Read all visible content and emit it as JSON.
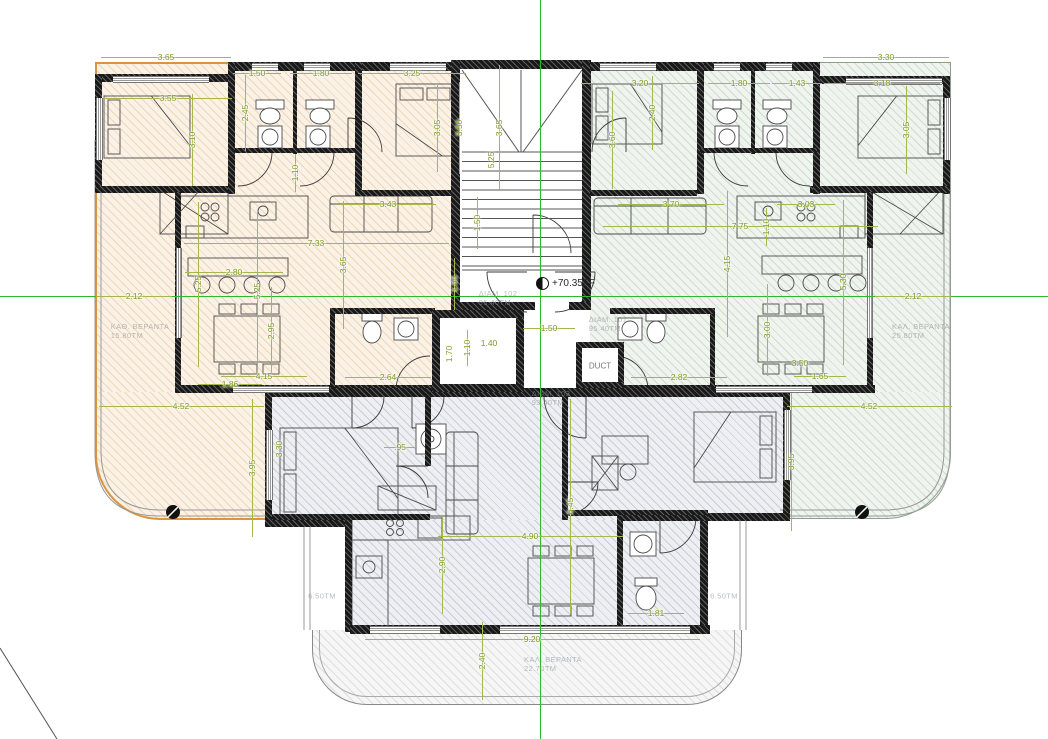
{
  "drawing": {
    "title": "apartment-floor-plan",
    "annotations": {
      "level_marker": "+70.35FF",
      "duct_label": "DUCT"
    },
    "area_labels": [
      {
        "lines": [
          "ΚΑΘ. ΒΕΡΑΝΤΑ",
          "15.80ΤΜ"
        ],
        "x": 140,
        "y": 331
      },
      {
        "lines": [
          "ΚΑΛ. ΒΕΡΑΝΤΑ",
          "25.80ΤΜ"
        ],
        "x": 921,
        "y": 331
      },
      {
        "lines": [
          "ΚΑΛ. ΒΕΡΑΝΤΑ",
          "22.70ΤΜ"
        ],
        "x": 553,
        "y": 664
      },
      {
        "lines": [
          "6.50ΤΜ"
        ],
        "x": 322,
        "y": 596
      },
      {
        "lines": [
          "6.50ΤΜ"
        ],
        "x": 724,
        "y": 596
      },
      {
        "lines": [
          "ΔΙΑΜ. 102",
          "95.40ΤΜ"
        ],
        "x": 498,
        "y": 298
      },
      {
        "lines": [
          "ΔΙΑΜ. 101",
          "95.40ΤΜ"
        ],
        "x": 608,
        "y": 324
      },
      {
        "lines": [
          "ΔΙΑΜ. 103",
          "93.40ΤΜ"
        ],
        "x": 551,
        "y": 398
      }
    ],
    "dimensions": [
      {
        "t": "3.65",
        "x": 166,
        "y": 57,
        "v": false,
        "len": 130
      },
      {
        "t": "1.50",
        "x": 257,
        "y": 73,
        "v": false,
        "len": 48
      },
      {
        "t": "1.80",
        "x": 321,
        "y": 73,
        "v": false,
        "len": 62
      },
      {
        "t": "3.25",
        "x": 412,
        "y": 73,
        "v": false,
        "len": 108
      },
      {
        "t": "3.55",
        "x": 168,
        "y": 98,
        "v": false,
        "len": 128
      },
      {
        "t": "3.10",
        "x": 192,
        "y": 140,
        "v": true,
        "len": 92
      },
      {
        "t": "2.45",
        "x": 245,
        "y": 113,
        "v": true,
        "len": 76
      },
      {
        "t": "3.05",
        "x": 437,
        "y": 128,
        "v": true,
        "len": 88
      },
      {
        "t": "3.50",
        "x": 459,
        "y": 128,
        "v": true,
        "len": 92
      },
      {
        "t": "1.10",
        "x": 295,
        "y": 173,
        "v": true,
        "len": 38
      },
      {
        "t": "3.43",
        "x": 388,
        "y": 204,
        "v": false,
        "len": 96
      },
      {
        "t": "7.33",
        "x": 316,
        "y": 243,
        "v": false,
        "len": 265
      },
      {
        "t": "2.80",
        "x": 234,
        "y": 272,
        "v": false,
        "len": 98
      },
      {
        "t": "5.25",
        "x": 198,
        "y": 284,
        "v": true,
        "len": 165
      },
      {
        "t": "5.25",
        "x": 257,
        "y": 291,
        "v": true,
        "len": 158
      },
      {
        "t": "2.95",
        "x": 271,
        "y": 331,
        "v": true,
        "len": 88
      },
      {
        "t": "3.65",
        "x": 343,
        "y": 265,
        "v": true,
        "len": 128
      },
      {
        "t": "2.12",
        "x": 134,
        "y": 296,
        "v": false,
        "len": 76
      },
      {
        "t": "1.86",
        "x": 230,
        "y": 384,
        "v": false,
        "len": 64
      },
      {
        "t": "4.15",
        "x": 264,
        "y": 376,
        "v": false,
        "len": 86
      },
      {
        "t": "4.52",
        "x": 181,
        "y": 406,
        "v": false,
        "len": 165
      },
      {
        "t": "2.64",
        "x": 388,
        "y": 377,
        "v": false,
        "len": 86
      },
      {
        "t": "3.95",
        "x": 252,
        "y": 468,
        "v": true,
        "len": 138
      },
      {
        "t": "3.30",
        "x": 279,
        "y": 449,
        "v": true,
        "len": 0
      },
      {
        "t": "3.65",
        "x": 499,
        "y": 128,
        "v": true,
        "len": 126
      },
      {
        "t": "5.25",
        "x": 491,
        "y": 160,
        "v": true,
        "len": 0
      },
      {
        "t": "1.50",
        "x": 477,
        "y": 223,
        "v": true,
        "len": 52
      },
      {
        "t": "1.55",
        "x": 454,
        "y": 284,
        "v": true,
        "len": 52
      },
      {
        "t": "1.70",
        "x": 449,
        "y": 354,
        "v": true,
        "len": 0
      },
      {
        "t": "1.10",
        "x": 467,
        "y": 348,
        "v": true,
        "len": 36
      },
      {
        "t": "1.40",
        "x": 489,
        "y": 343,
        "v": false,
        "len": 0
      },
      {
        "t": "1.50",
        "x": 549,
        "y": 328,
        "v": false,
        "len": 52
      },
      {
        "t": "3.30",
        "x": 886,
        "y": 57,
        "v": false,
        "len": 126
      },
      {
        "t": "3.20",
        "x": 640,
        "y": 83,
        "v": false,
        "len": 118
      },
      {
        "t": "1.80",
        "x": 739,
        "y": 83,
        "v": false,
        "len": 62
      },
      {
        "t": "1.43",
        "x": 797,
        "y": 83,
        "v": false,
        "len": 50
      },
      {
        "t": "3.18",
        "x": 882,
        "y": 83,
        "v": false,
        "len": 116
      },
      {
        "t": "3.60",
        "x": 612,
        "y": 140,
        "v": true,
        "len": 98
      },
      {
        "t": "2.40",
        "x": 652,
        "y": 113,
        "v": true,
        "len": 74
      },
      {
        "t": "3.05",
        "x": 906,
        "y": 130,
        "v": true,
        "len": 88
      },
      {
        "t": "1.10",
        "x": 766,
        "y": 227,
        "v": true,
        "len": 38
      },
      {
        "t": "3.70",
        "x": 671,
        "y": 204,
        "v": false,
        "len": 106
      },
      {
        "t": "7.75",
        "x": 740,
        "y": 226,
        "v": false,
        "len": 275
      },
      {
        "t": "3.03",
        "x": 806,
        "y": 204,
        "v": false,
        "len": 58
      },
      {
        "t": "4.15",
        "x": 727,
        "y": 264,
        "v": true,
        "len": 146
      },
      {
        "t": "5.30",
        "x": 843,
        "y": 282,
        "v": true,
        "len": 165
      },
      {
        "t": "3.00",
        "x": 767,
        "y": 330,
        "v": true,
        "len": 92
      },
      {
        "t": "3.50",
        "x": 800,
        "y": 363,
        "v": false,
        "len": 0
      },
      {
        "t": "1.65",
        "x": 820,
        "y": 376,
        "v": false,
        "len": 52
      },
      {
        "t": "2.12",
        "x": 913,
        "y": 296,
        "v": false,
        "len": 76
      },
      {
        "t": "4.52",
        "x": 869,
        "y": 406,
        "v": false,
        "len": 165
      },
      {
        "t": "3.95",
        "x": 791,
        "y": 462,
        "v": true,
        "len": 138
      },
      {
        "t": "2.82",
        "x": 679,
        "y": 377,
        "v": false,
        "len": 96
      },
      {
        "t": ".95",
        "x": 400,
        "y": 447,
        "v": false,
        "len": 33
      },
      {
        "t": "4.90",
        "x": 530,
        "y": 536,
        "v": false,
        "len": 185
      },
      {
        "t": "2.90",
        "x": 442,
        "y": 565,
        "v": true,
        "len": 98
      },
      {
        "t": "6.45",
        "x": 570,
        "y": 506,
        "v": true,
        "len": 215
      },
      {
        "t": "1.81",
        "x": 656,
        "y": 613,
        "v": false,
        "len": 56
      },
      {
        "t": "9.20",
        "x": 532,
        "y": 639,
        "v": false,
        "len": 335
      },
      {
        "t": "2.40",
        "x": 482,
        "y": 661,
        "v": true,
        "len": 78
      }
    ],
    "colors": {
      "dim_green": "#7e9c24",
      "dim_line_green": "#a3b84a",
      "centerline_green": "#2db82d",
      "orange_unit_edge": "#d9953f",
      "wall": "#191919",
      "faint_text": "#8a8f94"
    }
  }
}
